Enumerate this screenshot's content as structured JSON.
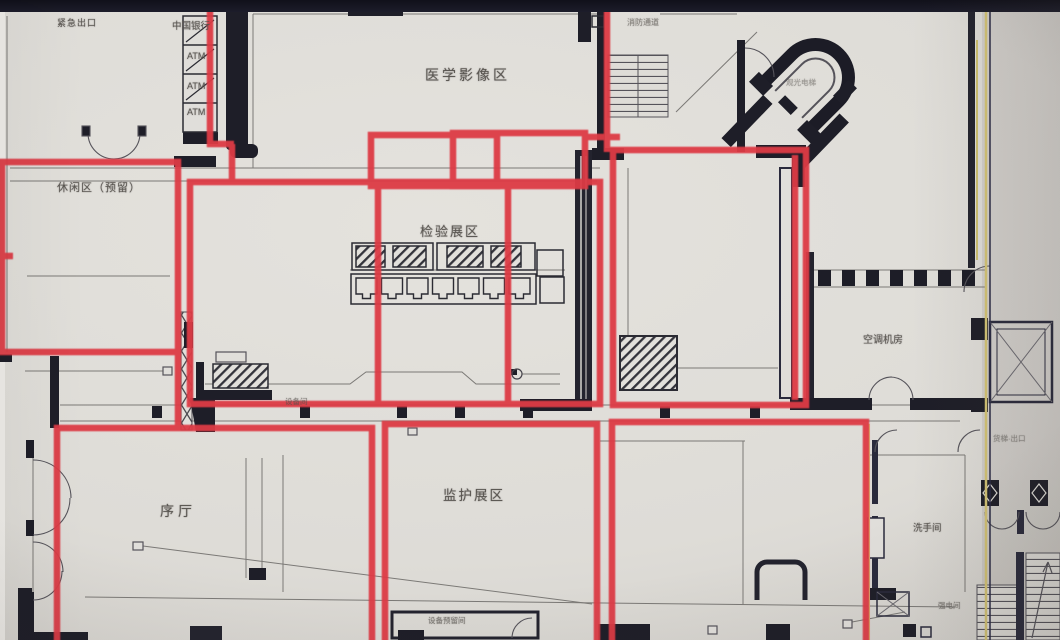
{
  "labels": {
    "emergency_exit": "紧急出口",
    "bank": "中国银行",
    "atm": "ATM",
    "imaging_area": "医学影像区",
    "fire_passage": "消防通道",
    "sightseeing_elevator": "观光电梯",
    "leisure_area": "休闲区（预留）",
    "inspection_area": "检验展区",
    "hvac_room": "空调机房",
    "equipment_room": "设备间",
    "prologue_hall": "序厅",
    "monitoring_area": "监护展区",
    "equipment_reserve_room": "设备预留间",
    "freight_exit": "货梯·出口",
    "restroom": "洗手间",
    "electrical_room": "强电间"
  },
  "colors": {
    "marker_red": "#dd3b44",
    "paper": "#dedcd7",
    "wall_ink": "#1e1e28",
    "bezel": "#14141e",
    "fringe_yellow": "#cdbf6e"
  },
  "annotations": {
    "color": "#dd3b44",
    "stroke_width": 6.5,
    "boxes": [
      {
        "x": 2,
        "y": 162,
        "w": 176,
        "h": 190
      },
      {
        "x": 190,
        "y": 182,
        "w": 410,
        "h": 222
      },
      {
        "x": 371,
        "y": 135,
        "w": 126,
        "h": 51
      },
      {
        "x": 453,
        "y": 133,
        "w": 132,
        "h": 53
      },
      {
        "x": 613,
        "y": 150,
        "w": 193,
        "h": 255
      },
      {
        "x": 57,
        "y": 428,
        "w": 315,
        "h": 230
      },
      {
        "x": 385,
        "y": 424,
        "w": 212,
        "h": 234
      },
      {
        "x": 612,
        "y": 422,
        "w": 254,
        "h": 236
      }
    ],
    "lines": [
      {
        "x1": 210,
        "y1": 0,
        "x2": 210,
        "y2": 147
      },
      {
        "x1": 207,
        "y1": 144,
        "x2": 234,
        "y2": 144
      },
      {
        "x1": 232,
        "y1": 144,
        "x2": 232,
        "y2": 185
      },
      {
        "x1": 378,
        "y1": 184,
        "x2": 378,
        "y2": 406
      },
      {
        "x1": 508,
        "y1": 184,
        "x2": 508,
        "y2": 406
      },
      {
        "x1": 607,
        "y1": 8,
        "x2": 607,
        "y2": 152
      },
      {
        "x1": 583,
        "y1": 137,
        "x2": 620,
        "y2": 137
      },
      {
        "x1": 178,
        "y1": 350,
        "x2": 178,
        "y2": 430
      },
      {
        "x1": 795,
        "y1": 155,
        "x2": 795,
        "y2": 400
      },
      {
        "x1": 0,
        "y1": 256,
        "x2": 13,
        "y2": 256
      }
    ]
  }
}
